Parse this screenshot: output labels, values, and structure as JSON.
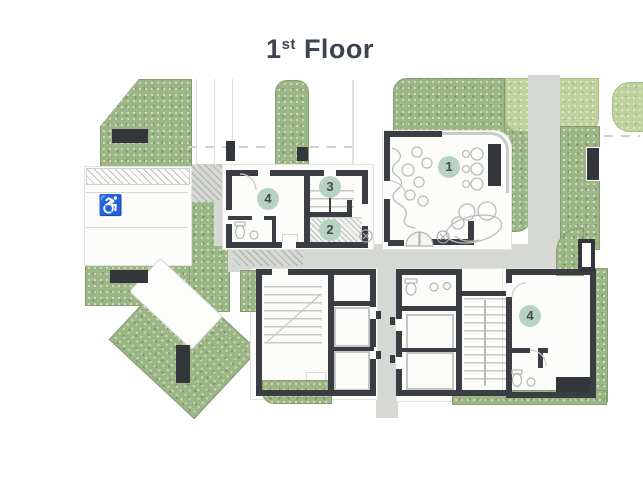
{
  "title": {
    "number": "1",
    "ordinal": "st",
    "word": "Floor"
  },
  "units": [
    {
      "label": "1"
    },
    {
      "label": "2"
    },
    {
      "label": "3"
    },
    {
      "label": "4"
    },
    {
      "label": "4"
    }
  ],
  "icons": {
    "accessible_parking": "♿"
  },
  "colors": {
    "marker_bg": "#b7d2c2",
    "marker_text": "#3f4c48",
    "wall": "#3a3d41",
    "landscape_green": "#9cb686",
    "landscape_green_light": "#bdd29c",
    "road_gray": "#d6d8d4",
    "sketch_gray": "#b9bdb8",
    "title_text": "#3e454e"
  }
}
